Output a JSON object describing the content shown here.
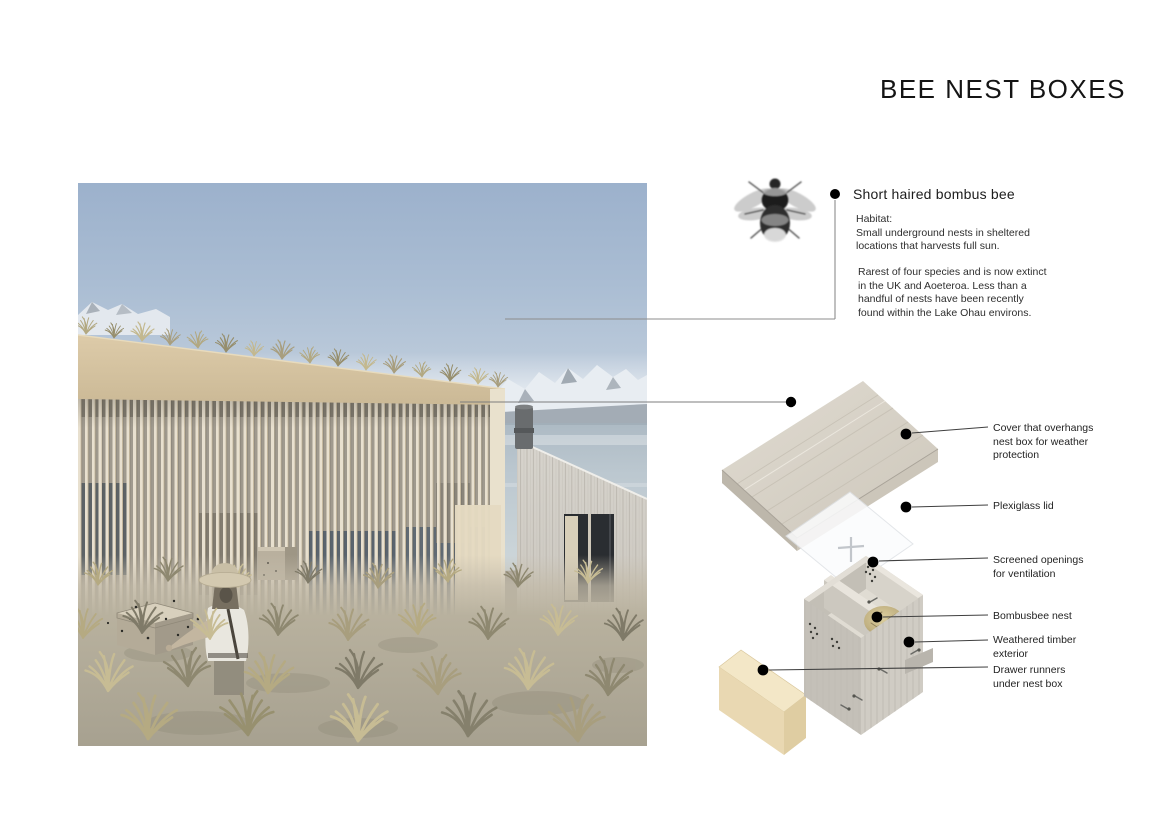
{
  "title": "BEE NEST BOXES",
  "bee": {
    "heading": "Short haired bombus bee",
    "habitat": "Habitat:\nSmall underground nests in sheltered\nlocations that harvests full sun.",
    "rarity": "Rarest of four species and is now extinct\nin the UK and Aoeteroa. Less than a\nhandful of nests have been recently\nfound within the Lake Ohau environs."
  },
  "callouts": [
    {
      "label": "Cover that overhangs\nnest box for weather\nprotection"
    },
    {
      "label": "Plexiglass lid"
    },
    {
      "label": "Screened openings\nfor ventilation"
    },
    {
      "label": "Bombusbee nest"
    },
    {
      "label": "Weathered timber\nexterior"
    },
    {
      "label": "Drawer runners\nunder nest box"
    }
  ],
  "colors": {
    "callout_dot": "#000000",
    "connector_line": "#6e6e6e",
    "cover_timber": "#d9d3c7",
    "box_timber": "#d0ccc4",
    "drawer_base_tan": "#f2e6c6",
    "fascia_tan": "#d8c6a4",
    "sky_top": "#9cb1cc",
    "lake": "#b6c2cb",
    "mountain_snow": "#e8edf2"
  }
}
